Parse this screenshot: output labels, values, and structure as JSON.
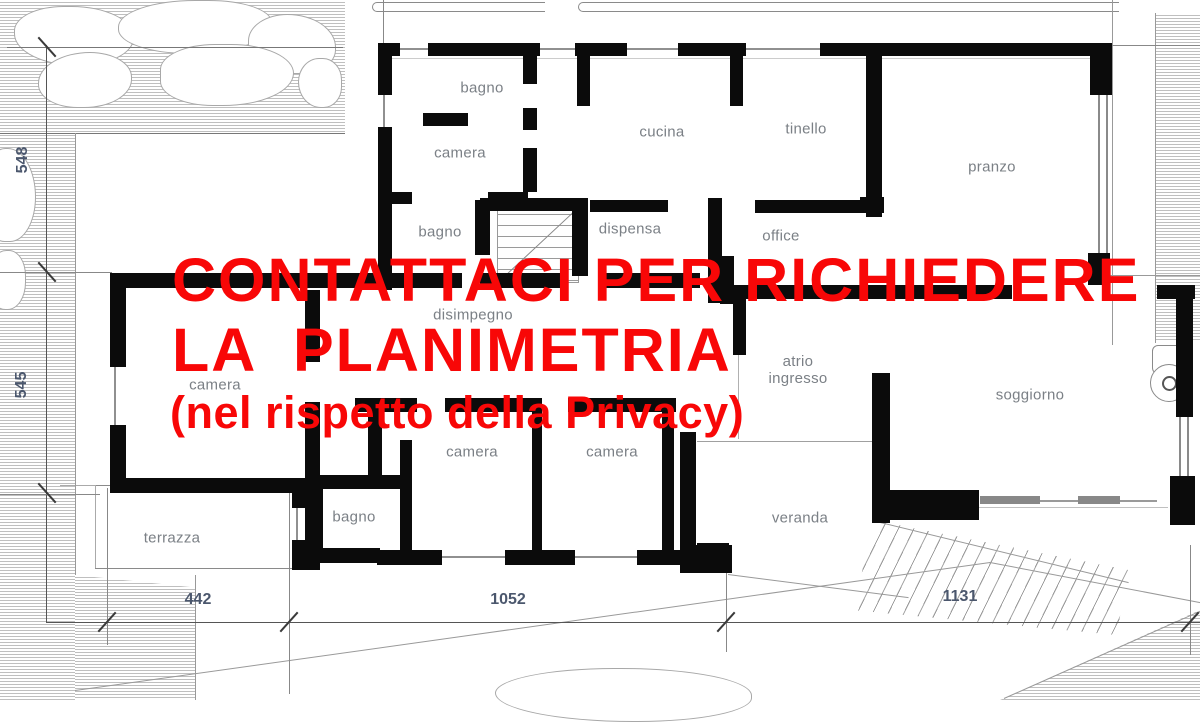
{
  "watermark": {
    "line1": "CONTATTACI PER RICHIEDERE",
    "line2": "LA  PLANIMETRIA",
    "line3": "(nel rispetto della Privacy)"
  },
  "rooms": {
    "bagno_top": "bagno",
    "camera_top": "camera",
    "bagno_mid": "bagno",
    "cucina": "cucina",
    "tinello": "tinello",
    "pranzo": "pranzo",
    "dispensa": "dispensa",
    "office": "office",
    "disimpegno": "disimpegno",
    "atrio_line1": "atrio",
    "atrio_line2": "ingresso",
    "soggiorno": "soggiorno",
    "camera_left": "camera",
    "camera_mid": "camera",
    "camera_right": "camera",
    "bagno_bottom": "bagno",
    "terrazza": "terrazza",
    "veranda": "veranda"
  },
  "dimensions": {
    "left_top": "548",
    "left_bottom": "545",
    "bottom_left": "442",
    "bottom_mid": "1052",
    "bottom_right": "1131"
  },
  "colors": {
    "wall": "#0b0b0b",
    "room_label": "#7b8086",
    "dimension_label": "#4b576d",
    "watermark_red": "#f80707",
    "hatch_line": "#bfbfbf"
  }
}
